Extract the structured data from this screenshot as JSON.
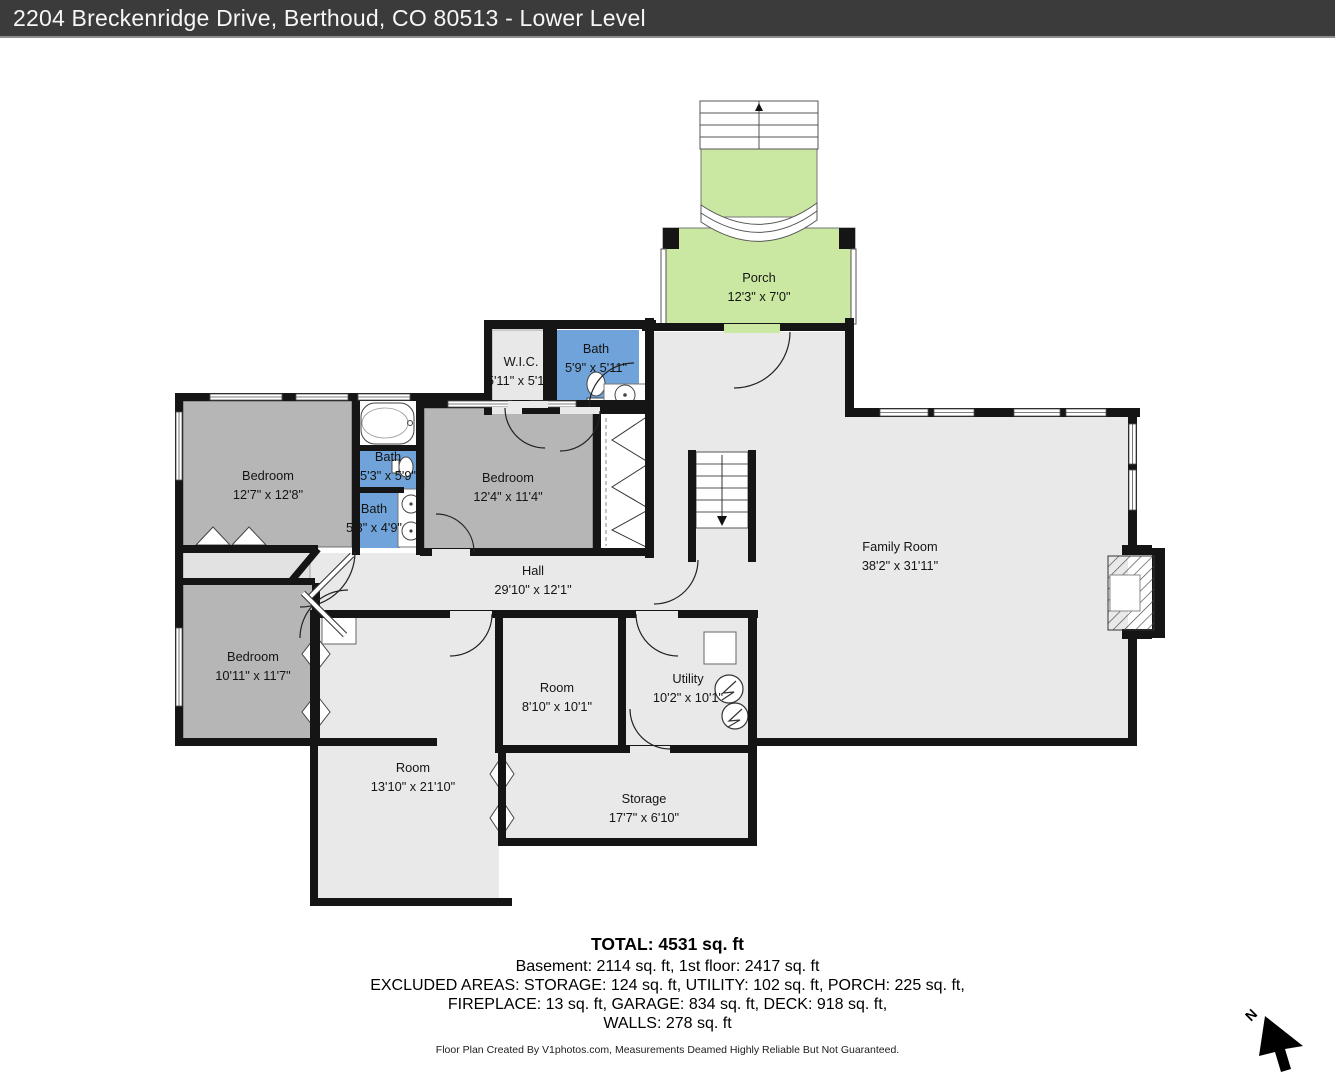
{
  "title_bar": {
    "title": "2204 Breckenridge Drive, Berthoud, CO 80513 - Lower Level"
  },
  "plan": {
    "rooms": {
      "porch": {
        "name": "Porch",
        "dims": "12'3\" x 7'0\""
      },
      "wic": {
        "name": "W.I.C.",
        "dims": "5'11\" x 5'11\""
      },
      "bath_upper": {
        "name": "Bath",
        "dims": "5'9\" x 5'11\""
      },
      "bedroom_upper_left": {
        "name": "Bedroom",
        "dims": "12'7\" x 12'8\""
      },
      "bath_middle": {
        "name": "Bath",
        "dims": "5'3\" x 5'9\""
      },
      "bath_lower": {
        "name": "Bath",
        "dims": "5'3\" x 4'9\""
      },
      "bedroom_middle": {
        "name": "Bedroom",
        "dims": "12'4\" x 11'4\""
      },
      "hall": {
        "name": "Hall",
        "dims": "29'10\" x 12'1\""
      },
      "family_room": {
        "name": "Family Room",
        "dims": "38'2\" x 31'11\""
      },
      "bedroom_lower_left": {
        "name": "Bedroom",
        "dims": "10'11\" x 11'7\""
      },
      "room_small": {
        "name": "Room",
        "dims": "8'10\" x 10'1\""
      },
      "utility": {
        "name": "Utility",
        "dims": "10'2\" x 10'1\""
      },
      "room_large": {
        "name": "Room",
        "dims": "13'10\" x 21'10\""
      },
      "storage": {
        "name": "Storage",
        "dims": "17'7\" x 6'10\""
      }
    },
    "compass": {
      "label": "N"
    }
  },
  "summary": {
    "total": "TOTAL: 4531 sq. ft",
    "line1": "Basement: 2114 sq. ft, 1st floor: 2417 sq. ft",
    "line2": "EXCLUDED AREAS: STORAGE: 124 sq. ft, UTILITY: 102 sq. ft, PORCH: 225 sq. ft,",
    "line3": "FIREPLACE: 13 sq. ft, GARAGE: 834 sq. ft, DECK: 918 sq. ft,",
    "line4": "WALLS: 278 sq. ft"
  },
  "footer": {
    "credit": "Floor Plan Created By V1photos.com, Measurements Deamed Highly Reliable But Not Guaranteed."
  },
  "colors": {
    "wall": "#151515",
    "bath_blue": "#6fa3d9",
    "porch_green": "#cbe8a2",
    "bedroom_gray": "#b6b6b6",
    "open_gray": "#e9e9e9",
    "title_bg": "#3b3b3b"
  }
}
